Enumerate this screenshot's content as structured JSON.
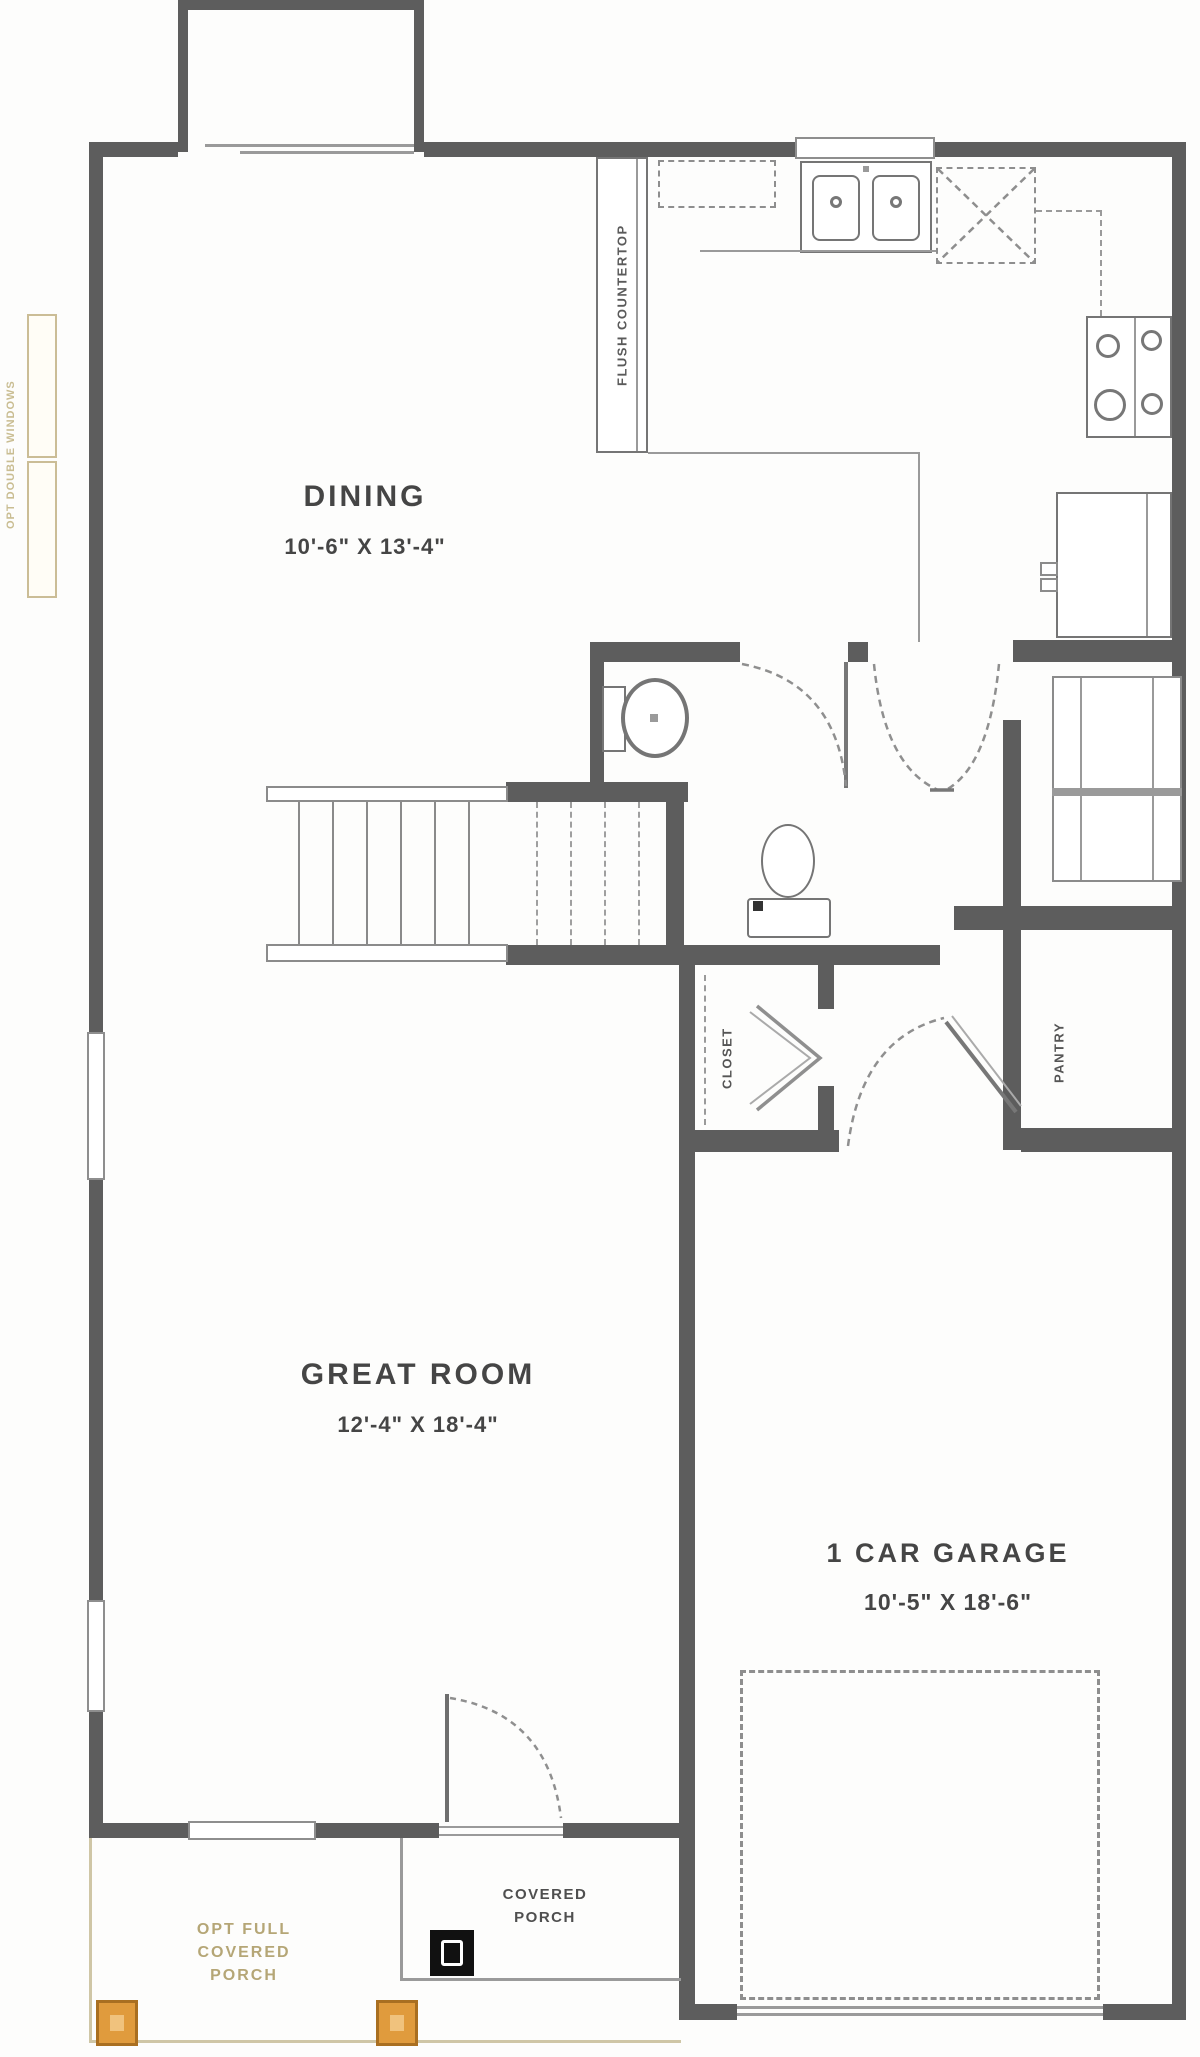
{
  "plan": {
    "rooms": {
      "dining": {
        "name": "DINING",
        "dims": "10'-6\" X 13'-4\""
      },
      "great_room": {
        "name": "GREAT ROOM",
        "dims": "12'-4\" X 18'-4\""
      },
      "garage": {
        "name": "1 CAR GARAGE",
        "dims": "10'-5\" X 18'-6\""
      },
      "closet": {
        "name": "CLOSET"
      },
      "pantry": {
        "name": "PANTRY"
      },
      "covered_porch": {
        "name": "COVERED\nPORCH"
      },
      "opt_porch": {
        "name": "OPT FULL\nCOVERED\nPORCH"
      }
    },
    "annotations": {
      "flush_countertop": "FLUSH COUNTERTOP",
      "opt_double_windows": "OPT DOUBLE WINDOWS"
    },
    "colors": {
      "wall": "#5d5d5d",
      "label": "#454545",
      "tan_text": "#b5a676",
      "tan_outline": "#cbbd96",
      "post_orange": "#e09b3d",
      "post_orange_border": "#a96f21",
      "post_black": "#111111"
    }
  }
}
